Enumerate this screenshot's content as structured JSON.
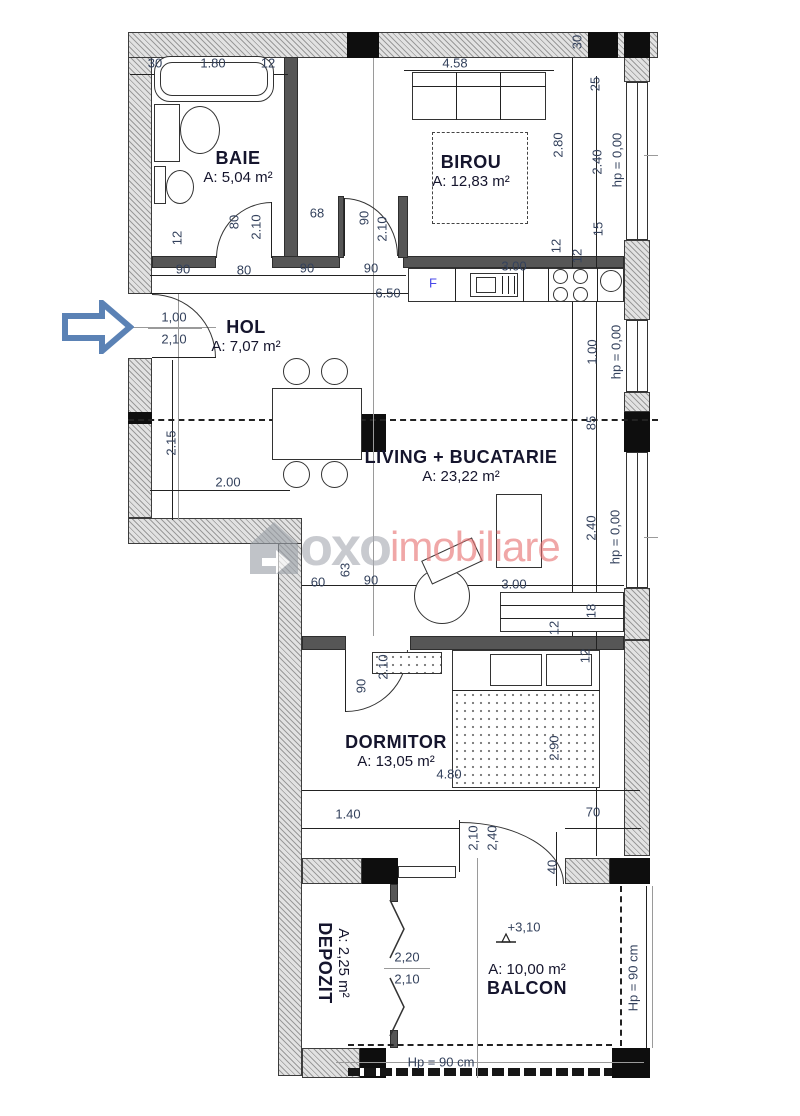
{
  "watermark": {
    "part1": "oxo",
    "part2": "imobiliare"
  },
  "rooms": [
    {
      "n": "BAIE",
      "a": "A: 5,04 m²",
      "x": 238,
      "y": 167
    },
    {
      "n": "BIROU",
      "a": "A: 12,83 m²",
      "x": 471,
      "y": 171
    },
    {
      "n": "HOL",
      "a": "A: 7,07 m²",
      "x": 246,
      "y": 336
    },
    {
      "n": "LIVING + BUCATARIE",
      "a": "A: 23,22 m²",
      "x": 461,
      "y": 466
    },
    {
      "n": "DORMITOR",
      "a": "A: 13,05 m²",
      "x": 396,
      "y": 751
    },
    {
      "n": "BALCON",
      "a": "A: 10,00 m²",
      "x": 527,
      "y": 980,
      "af": true
    },
    {
      "n": "DEPOZIT",
      "a": "A: 2,25 m²",
      "x": 333,
      "y": 963,
      "r": 90
    }
  ],
  "dims": [
    {
      "t": "30",
      "x": 155,
      "y": 63
    },
    {
      "t": "1.80",
      "x": 213,
      "y": 63
    },
    {
      "t": "12",
      "x": 268,
      "y": 63
    },
    {
      "t": "4.58",
      "x": 455,
      "y": 63
    },
    {
      "t": "30",
      "x": 577,
      "y": 42,
      "r": 1
    },
    {
      "t": "25",
      "x": 595,
      "y": 84,
      "r": 1
    },
    {
      "t": "2.80",
      "x": 558,
      "y": 145,
      "r": 1
    },
    {
      "t": "2.40",
      "x": 597,
      "y": 162,
      "r": 1
    },
    {
      "t": "hp = 0,00",
      "x": 617,
      "y": 160,
      "r": 1
    },
    {
      "t": "15",
      "x": 598,
      "y": 229,
      "r": 1
    },
    {
      "t": "12",
      "x": 556,
      "y": 246,
      "r": 1
    },
    {
      "t": "12",
      "x": 577,
      "y": 256,
      "r": 1
    },
    {
      "t": "12",
      "x": 177,
      "y": 238,
      "r": 1
    },
    {
      "t": "80",
      "x": 234,
      "y": 222,
      "r": 1
    },
    {
      "t": "2.10",
      "x": 256,
      "y": 227,
      "r": 1
    },
    {
      "t": "68",
      "x": 317,
      "y": 213
    },
    {
      "t": "90",
      "x": 364,
      "y": 218,
      "r": 1
    },
    {
      "t": "2.10",
      "x": 382,
      "y": 229,
      "r": 1
    },
    {
      "t": "90",
      "x": 183,
      "y": 269
    },
    {
      "t": "80",
      "x": 244,
      "y": 270
    },
    {
      "t": "90",
      "x": 307,
      "y": 268
    },
    {
      "t": "90",
      "x": 371,
      "y": 268
    },
    {
      "t": "6.50",
      "x": 388,
      "y": 293
    },
    {
      "t": "3.00",
      "x": 514,
      "y": 266
    },
    {
      "t": "F",
      "x": 433,
      "y": 283,
      "c": "blue"
    },
    {
      "t": "1,00",
      "x": 174,
      "y": 317
    },
    {
      "t": "2,10",
      "x": 174,
      "y": 339
    },
    {
      "t": "2.15",
      "x": 171,
      "y": 443,
      "r": 1
    },
    {
      "t": "2.00",
      "x": 228,
      "y": 482
    },
    {
      "t": "1.00",
      "x": 592,
      "y": 352,
      "r": 1
    },
    {
      "t": "hp = 0,00",
      "x": 616,
      "y": 352,
      "r": 1
    },
    {
      "t": "85",
      "x": 591,
      "y": 423,
      "r": 1
    },
    {
      "t": "2.40",
      "x": 591,
      "y": 528,
      "r": 1
    },
    {
      "t": "hp = 0,00",
      "x": 615,
      "y": 537,
      "r": 1
    },
    {
      "t": "18",
      "x": 591,
      "y": 611,
      "r": 1
    },
    {
      "t": "12",
      "x": 554,
      "y": 628,
      "r": 1
    },
    {
      "t": "60",
      "x": 318,
      "y": 582
    },
    {
      "t": "63",
      "x": 345,
      "y": 570,
      "r": 1
    },
    {
      "t": "90",
      "x": 371,
      "y": 580
    },
    {
      "t": "3.00",
      "x": 514,
      "y": 584
    },
    {
      "t": "12",
      "x": 585,
      "y": 656,
      "r": 1
    },
    {
      "t": "90",
      "x": 361,
      "y": 686,
      "r": 1
    },
    {
      "t": "2.10",
      "x": 383,
      "y": 667,
      "r": 1
    },
    {
      "t": "2.90",
      "x": 554,
      "y": 748,
      "r": 1
    },
    {
      "t": "4.80",
      "x": 449,
      "y": 774
    },
    {
      "t": "1.40",
      "x": 348,
      "y": 814
    },
    {
      "t": "70",
      "x": 593,
      "y": 812
    },
    {
      "t": "40",
      "x": 552,
      "y": 867,
      "r": 1
    },
    {
      "t": "2,40",
      "x": 492,
      "y": 838,
      "r": 1
    },
    {
      "t": "2,10",
      "x": 473,
      "y": 838,
      "r": 1
    },
    {
      "t": "2,20",
      "x": 407,
      "y": 957
    },
    {
      "t": "2,10",
      "x": 407,
      "y": 979
    },
    {
      "t": "+3,10",
      "x": 524,
      "y": 927
    },
    {
      "t": "Hp = 90 cm",
      "x": 441,
      "y": 1062
    },
    {
      "t": "Hp = 90 cm",
      "x": 633,
      "y": 978,
      "r": 1
    }
  ]
}
